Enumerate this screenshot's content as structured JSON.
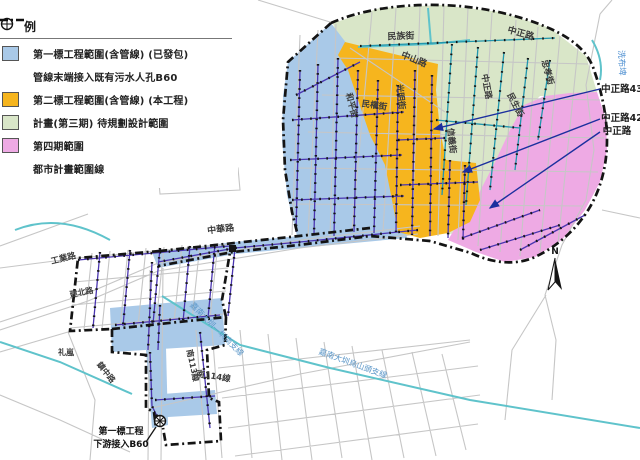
{
  "legend": {
    "title": "例",
    "items": [
      {
        "type": "swatch",
        "color": "#a9c9e8",
        "label": "第一標工程範圍(含管線) (已發包)"
      },
      {
        "type": "manhole",
        "color": "#111111",
        "label": "管線末端接入既有污水人孔B60"
      },
      {
        "type": "swatch",
        "color": "#f6b51e",
        "label": "第二標工程範圍(含管線) (本工程)"
      },
      {
        "type": "swatch",
        "color": "#d9e6c8",
        "label": "計畫(第三期) 待規劃設計範圍"
      },
      {
        "type": "swatch",
        "color": "#eeaae4",
        "label": "第四期範圍"
      },
      {
        "type": "dashline",
        "color": "#111111",
        "label": "都市計畫範圍線"
      }
    ]
  },
  "colors": {
    "zone_contract1_blue": "#a9c9e8",
    "zone_contract2_orange": "#f6b51e",
    "zone_phase3_green": "#d9e6c8",
    "zone_phase4_pink": "#eeaae4",
    "pipeline_purple": "#4a35b0",
    "planned_pipeline_teal": "#2196ad",
    "canal_teal": "#5fc3cb",
    "street_grey": "#c6c6c6",
    "boundary_black": "#141414",
    "arrow_blue": "#1b2f9e"
  },
  "map": {
    "north_label": "N",
    "labels": [
      {
        "name": "street-label-minzu-st",
        "text": "民族街",
        "x": 401,
        "y": 39,
        "r": -2,
        "size": 9,
        "color": "#3b3b3b",
        "bold": true
      },
      {
        "name": "street-label-zhongzheng-rd-top",
        "text": "中正路",
        "x": 520,
        "y": 36,
        "r": 16,
        "size": 9,
        "color": "#3b3b3b",
        "bold": true
      },
      {
        "name": "street-label-zhongshan-rd",
        "text": "中山路",
        "x": 413,
        "y": 62,
        "r": 22,
        "size": 9,
        "color": "#3b3b3b",
        "bold": true
      },
      {
        "name": "street-label-guangming-st",
        "text": "光明街",
        "x": 398,
        "y": 97,
        "r": 84,
        "size": 8.5,
        "color": "#3b3b3b",
        "bold": true
      },
      {
        "name": "street-label-heping-st",
        "text": "和平街",
        "x": 349,
        "y": 106,
        "r": 76,
        "size": 8.5,
        "color": "#3b3b3b",
        "bold": true
      },
      {
        "name": "street-label-minquan-st",
        "text": "民權街",
        "x": 374,
        "y": 108,
        "r": 8,
        "size": 8.5,
        "color": "#3b3b3b",
        "bold": true
      },
      {
        "name": "street-label-xinyi-st",
        "text": "信義街",
        "x": 449,
        "y": 141,
        "r": 84,
        "size": 8.5,
        "color": "#3b3b3b",
        "bold": true
      },
      {
        "name": "street-label-zhongzheng-rd-mid",
        "text": "中正路",
        "x": 484,
        "y": 87,
        "r": 80,
        "size": 8.5,
        "color": "#3b3b3b",
        "bold": true
      },
      {
        "name": "street-label-minsheng-st",
        "text": "民生街",
        "x": 513,
        "y": 106,
        "r": 62,
        "size": 8.5,
        "color": "#3b3b3b",
        "bold": true
      },
      {
        "name": "street-label-zhongxiao-st",
        "text": "忠孝街",
        "x": 545,
        "y": 73,
        "r": 74,
        "size": 8.5,
        "color": "#3b3b3b",
        "bold": true
      },
      {
        "name": "water-label-xibupi",
        "text": "洗布埤",
        "x": 619,
        "y": 63,
        "r": 87,
        "size": 8.5,
        "color": "#4d8fd1",
        "bold": false
      },
      {
        "name": "callout-label-zhongzheng-43",
        "text": "中正路43",
        "x": 622,
        "y": 92,
        "r": 0,
        "size": 9.5,
        "color": "#1c1c1c",
        "bold": true
      },
      {
        "name": "callout-label-zhongzheng-42",
        "text": "中正路42",
        "x": 622,
        "y": 121,
        "r": 0,
        "size": 9.5,
        "color": "#1c1c1c",
        "bold": true
      },
      {
        "name": "callout-label-zhongzheng",
        "text": "中正路",
        "x": 617,
        "y": 134,
        "r": 0,
        "size": 9.5,
        "color": "#1c1c1c",
        "bold": true
      },
      {
        "name": "street-label-zhonghua-rd",
        "text": "中華路",
        "x": 221,
        "y": 232,
        "r": -7,
        "size": 9,
        "color": "#3b3b3b",
        "bold": true
      },
      {
        "name": "street-label-gongye-rd",
        "text": "工業路",
        "x": 64,
        "y": 261,
        "r": -14,
        "size": 8.5,
        "color": "#3b3b3b",
        "bold": true
      },
      {
        "name": "street-label-jianbei-rd",
        "text": "建北路",
        "x": 82,
        "y": 295,
        "r": -11,
        "size": 8,
        "color": "#3b3b3b",
        "bold": true
      },
      {
        "name": "street-label-zhenzhong-rd",
        "text": "鎮中路",
        "x": 104,
        "y": 374,
        "r": 52,
        "size": 8,
        "color": "#3b3b3b",
        "bold": true
      },
      {
        "name": "place-label-lilan",
        "text": "礼嵐",
        "x": 66,
        "y": 355,
        "r": 0,
        "size": 8,
        "color": "#3b3b3b",
        "bold": true
      },
      {
        "name": "road-label-nan-113",
        "text": "南113線",
        "x": 190,
        "y": 366,
        "r": 78,
        "size": 8,
        "color": "#3b3b3b",
        "bold": true
      },
      {
        "name": "road-label-nan-114",
        "text": "南114線",
        "x": 213,
        "y": 379,
        "r": 9,
        "size": 8.5,
        "color": "#3b3b3b",
        "bold": true
      },
      {
        "name": "canal-label-jianan-south",
        "text": "嘉南大圳—圳南支線",
        "x": 215,
        "y": 331,
        "r": 45,
        "size": 8,
        "color": "#5a96c8",
        "bold": false
      },
      {
        "name": "canal-label-jianan-wushantou",
        "text": "嘉南大圳烏山頭支線",
        "x": 352,
        "y": 366,
        "r": 20,
        "size": 8,
        "color": "#5a96c8",
        "bold": false
      },
      {
        "name": "annotation-line1",
        "text": "第一標工程",
        "x": 121,
        "y": 434,
        "r": 0,
        "size": 9,
        "color": "#111111",
        "bold": true
      },
      {
        "name": "annotation-line2",
        "text": "下游接入B60",
        "x": 121,
        "y": 447,
        "r": 0,
        "size": 9,
        "color": "#111111",
        "bold": true
      }
    ]
  }
}
